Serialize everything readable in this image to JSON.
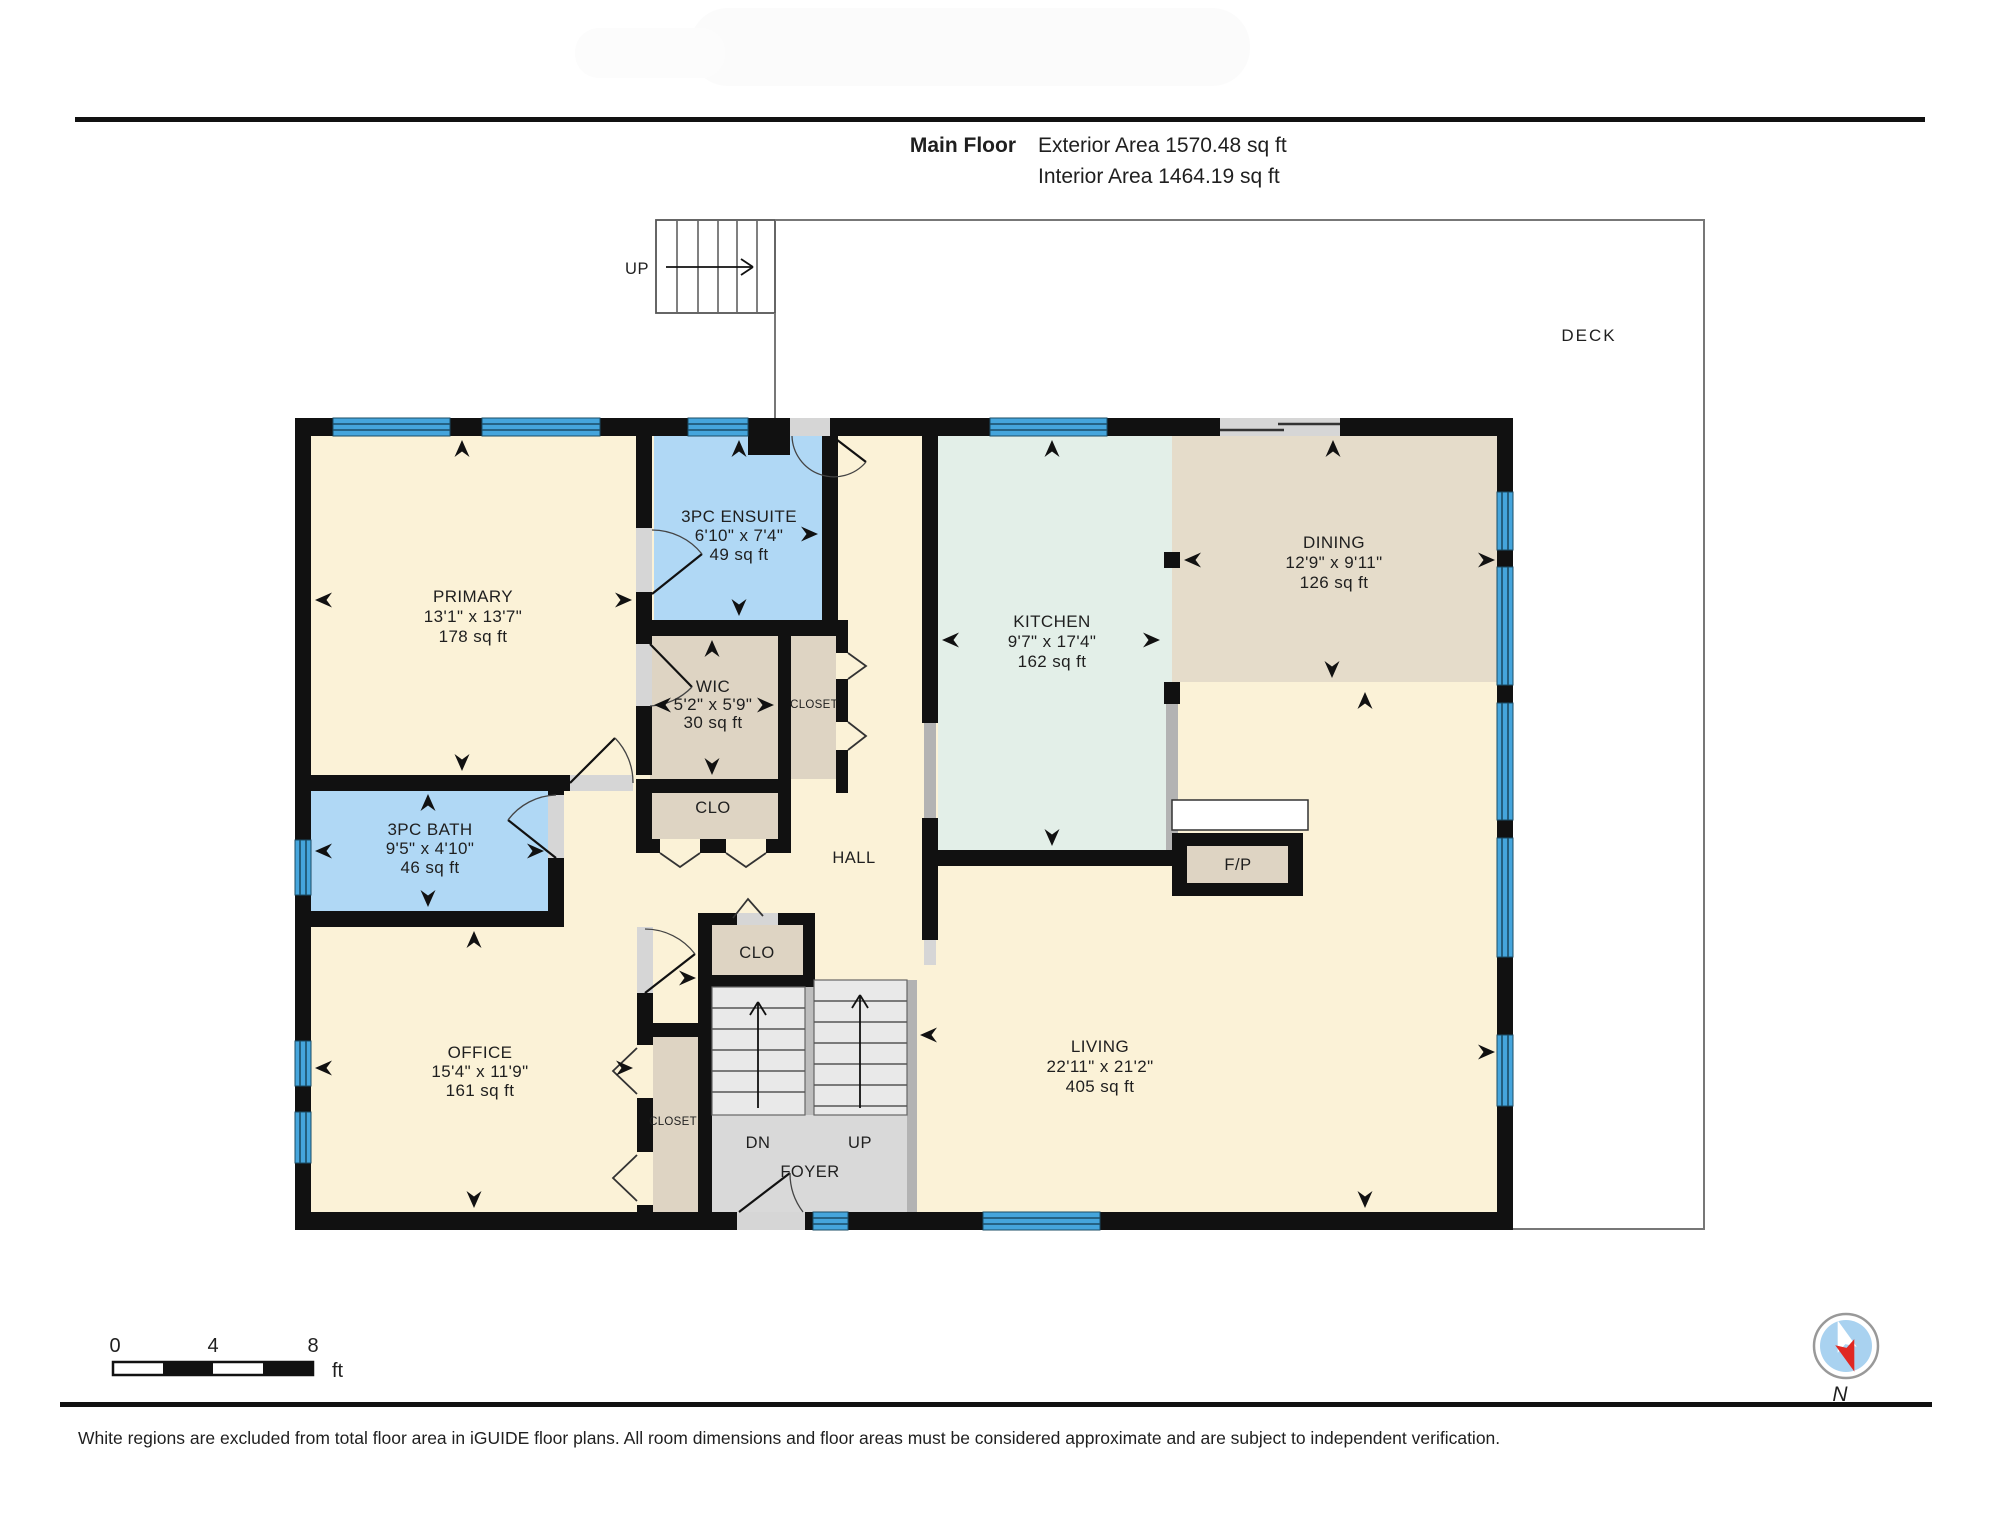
{
  "header": {
    "title": "Main Floor",
    "exterior": "Exterior Area 1570.48 sq ft",
    "interior": "Interior Area 1464.19 sq ft"
  },
  "rooms": {
    "primary": {
      "name": "PRIMARY",
      "dims": "13'1\" x 13'7\"",
      "area": "178 sq ft"
    },
    "ensuite": {
      "name": "3PC ENSUITE",
      "dims": "6'10\" x 7'4\"",
      "area": "49 sq ft"
    },
    "wic": {
      "name": "WIC",
      "dims": "5'2\" x 5'9\"",
      "area": "30 sq ft"
    },
    "bath": {
      "name": "3PC BATH",
      "dims": "9'5\" x 4'10\"",
      "area": "46 sq ft"
    },
    "office": {
      "name": "OFFICE",
      "dims": "15'4\" x 11'9\"",
      "area": "161 sq ft"
    },
    "kitchen": {
      "name": "KITCHEN",
      "dims": "9'7\" x 17'4\"",
      "area": "162 sq ft"
    },
    "dining": {
      "name": "DINING",
      "dims": "12'9\" x 9'11\"",
      "area": "126 sq ft"
    },
    "living": {
      "name": "LIVING",
      "dims": "22'11\" x 21'2\"",
      "area": "405 sq ft"
    }
  },
  "labels": {
    "hall": "HALL",
    "closet_hall": "CLOSET",
    "clo_wic": "CLO",
    "clo_foyer": "CLO",
    "closet_office": "CLOSET",
    "foyer": "FOYER",
    "dn": "DN",
    "up_foyer": "UP",
    "up_stairs": "UP",
    "deck": "DECK",
    "fireplace": "F/P",
    "compass_north": "N"
  },
  "scale_bar": {
    "ticks": [
      "0",
      "4",
      "8"
    ],
    "unit": "ft"
  },
  "footer": {
    "disclaimer": "White regions are excluded from total floor area in iGUIDE floor plans. All room dimensions and floor areas must be considered approximate and are subject to independent verification."
  },
  "colors": {
    "wall": "#111111",
    "window": "#45a5dc",
    "window_line": "#1b4d66",
    "cream": "#fbf2d7",
    "blue_room": "#b0d8f5",
    "tan_room": "#ded4c3",
    "dining_tan": "#e5dcca",
    "kitchen_green": "#e3efe8",
    "stairs_gray": "#e9e9e9",
    "floor_gray": "#d9d9d9",
    "halfwall_gray": "#b3b3b3",
    "sill_gray": "#d6d6d6",
    "deck_line": "#777777",
    "compass_blue": "#a9d2f0",
    "compass_red": "#e02823"
  }
}
